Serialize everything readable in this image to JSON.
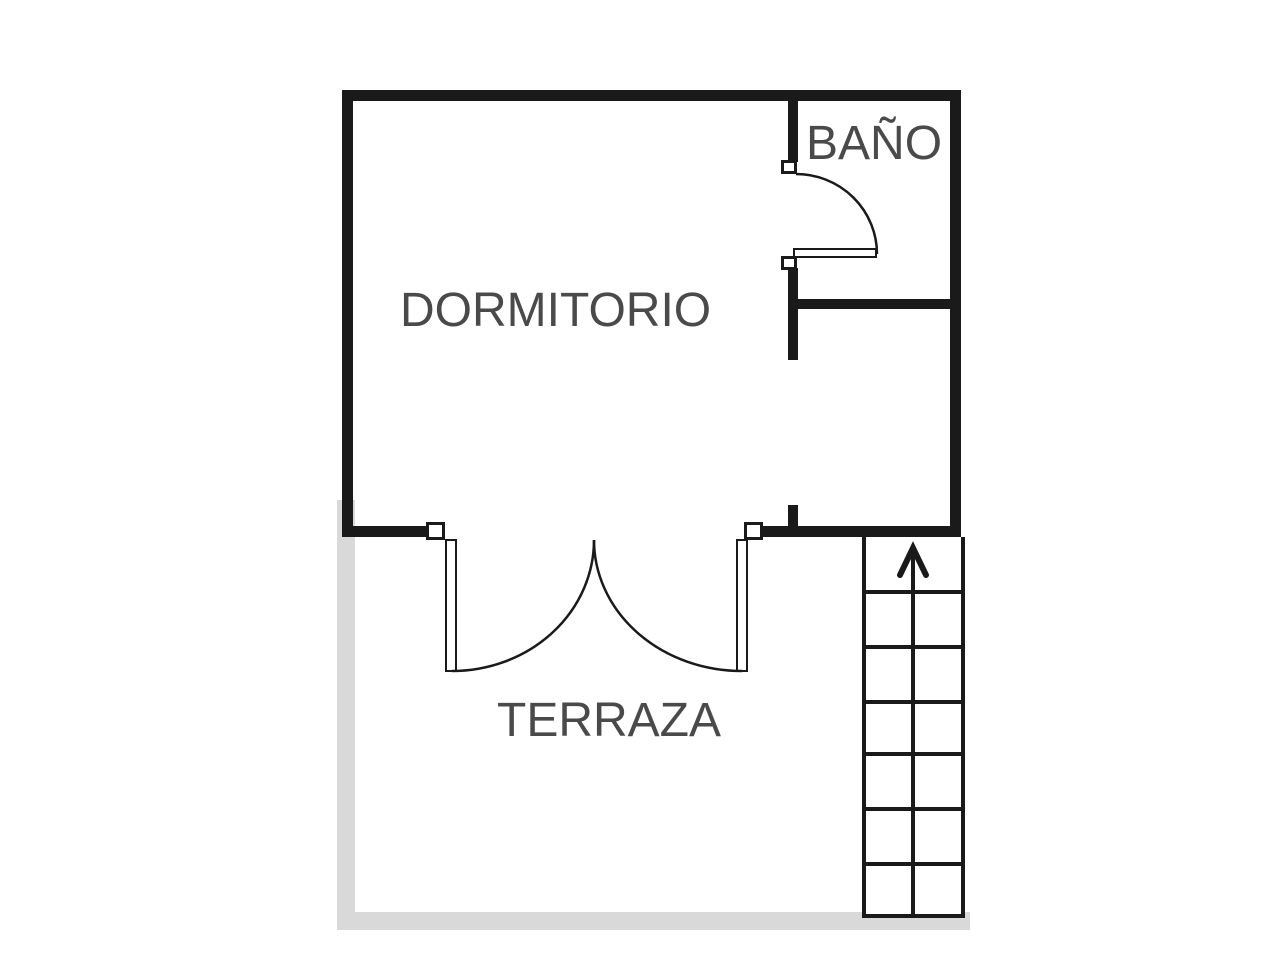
{
  "plan": {
    "type": "floor-plan",
    "rooms": {
      "dormitorio": {
        "label": "DORMITORIO"
      },
      "bano": {
        "label": "BAÑO"
      },
      "terraza": {
        "label": "TERRAZA"
      }
    },
    "stairs": {
      "direction": "up",
      "icon": "up-arrow-icon",
      "visible_steps": 7
    },
    "doors": {
      "bathroom_door": "single-swing-door",
      "terrace_door": "double-swing-door"
    },
    "colors": {
      "interior_wall": "#1a1a1a",
      "terrace_wall": "#d9d9d9",
      "label_text": "#4a4a4a",
      "background": "#ffffff"
    }
  }
}
